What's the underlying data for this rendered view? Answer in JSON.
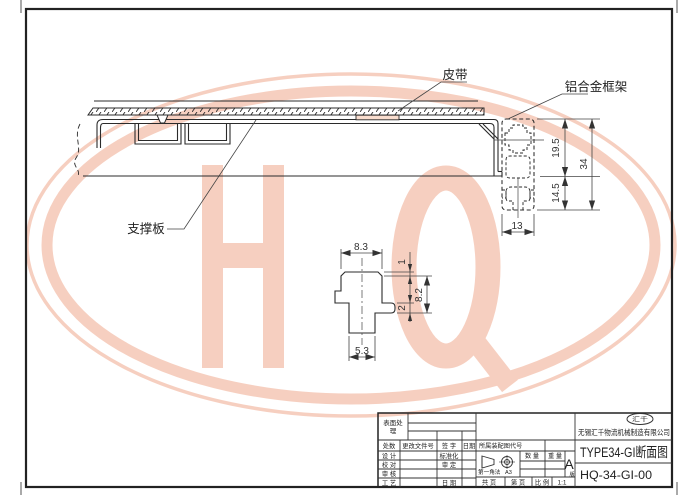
{
  "watermark": {
    "letters": "HQ",
    "color": "#efa183"
  },
  "annotations": {
    "belt": "皮带",
    "aluminum_frame": "铝合金框架",
    "support_plate": "支撑板"
  },
  "main_dims": {
    "upper_height": "19.5",
    "total_height": "34",
    "lower_height": "14.5",
    "profile_width": "13"
  },
  "detail_dims": {
    "top_width": "8.3",
    "top_lip": "1",
    "side_height": "8.2",
    "foot_thickness": "2",
    "stem_width": "5.3"
  },
  "title_block": {
    "surface_label_line1": "表面处",
    "surface_label_line2": "理",
    "rev_headers": [
      "处数",
      "更改文件号",
      "签 字",
      "日期"
    ],
    "row_labels": [
      "设 计",
      "校 对",
      "审 核",
      "工 艺"
    ],
    "mid_labels": [
      "标准化",
      "审 定",
      "日 期"
    ],
    "assembly_label": "所属装配图代号",
    "projection_method": "第一角法",
    "sheet_size": "A3",
    "qty_label": "数 量",
    "weight_label": "重 量",
    "version_letter": "A",
    "version_suffix": "版",
    "pages_label": "共 页",
    "page_label": "第 页",
    "scale_label": "比 例",
    "scale_value": "1:1",
    "logo_text": "汇千",
    "company": "无锡汇千物流机械制造有限公司",
    "drawing_title": "TYPE34-GI断面图",
    "drawing_number": "HQ-34-GI-00"
  }
}
